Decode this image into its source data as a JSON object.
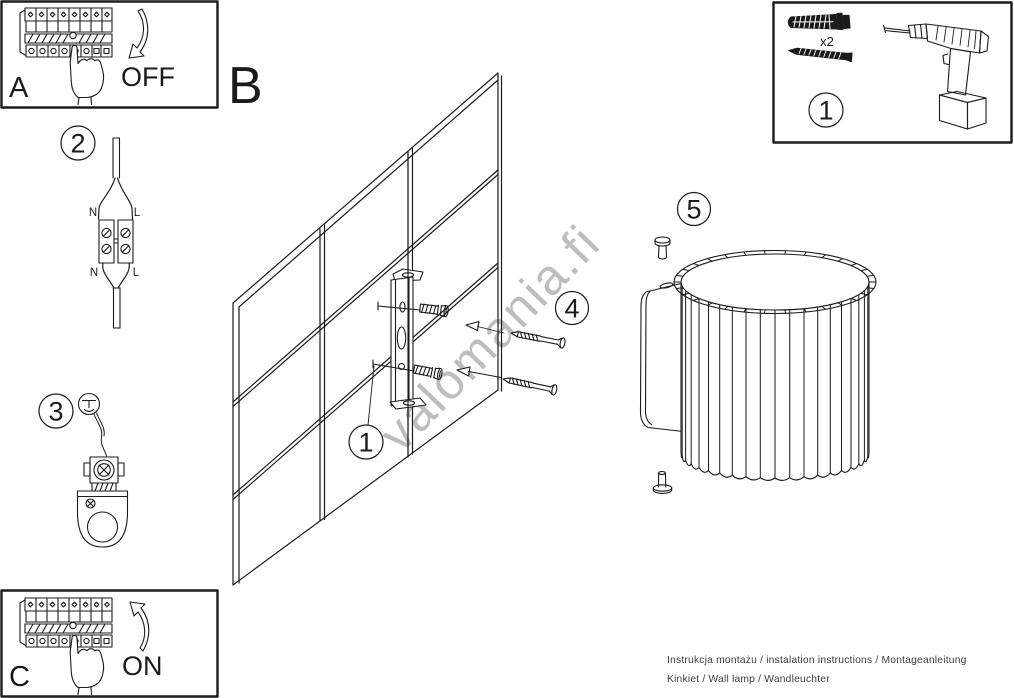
{
  "colors": {
    "ink": "#1b1b1b",
    "watermark": "#bdbdbd",
    "paper": "#ffffff",
    "footer_text": "#3c3c3c"
  },
  "section_labels": {
    "a": "A",
    "b": "B",
    "c": "C"
  },
  "breaker_states": {
    "off": "OFF",
    "on": "ON"
  },
  "badges": {
    "step1": "1",
    "step2": "2",
    "step3": "3",
    "step4": "4",
    "step5": "5",
    "tools": "1"
  },
  "wire_labels": {
    "top_neutral": "N",
    "top_live": "L",
    "bottom_neutral": "N",
    "bottom_live": "L"
  },
  "toolbox": {
    "anchor_qty": "x2"
  },
  "watermark": {
    "text": "valomania.fi"
  },
  "footer": {
    "line1": "Instrukcja montażu / instalation instructions / Montageanleitung",
    "line2": "Kinkiet / Wall lamp / Wandleuchter"
  }
}
